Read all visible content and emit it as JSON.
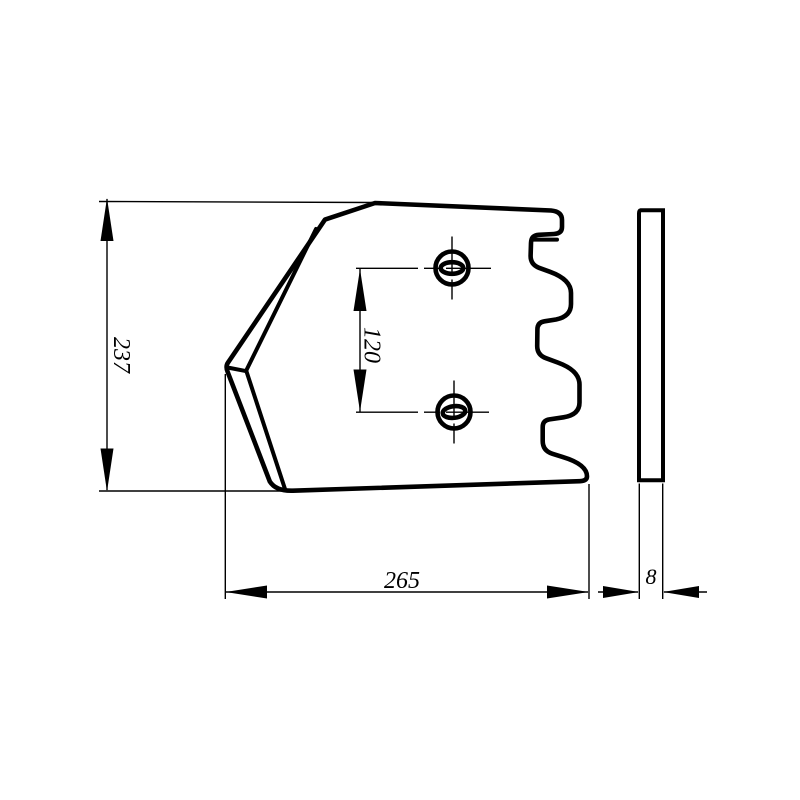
{
  "drawing": {
    "background_color": "#ffffff",
    "line_color": "#000000",
    "dimensions": {
      "height": "237",
      "hole_spacing": "120",
      "width": "265",
      "thickness": "8"
    }
  }
}
